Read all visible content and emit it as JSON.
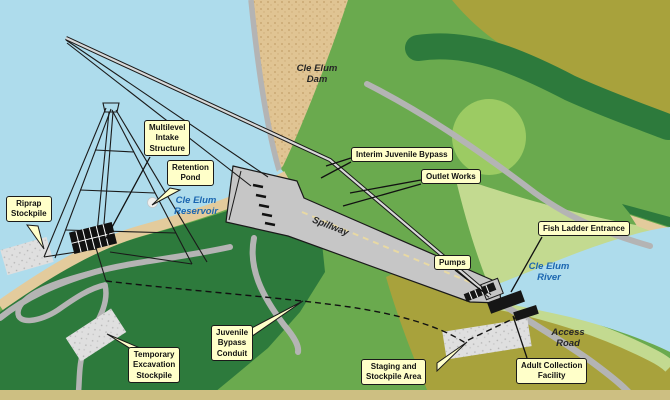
{
  "figure": {
    "type": "site-plan-map",
    "subject": "Cle Elum Dam fish passage facilities site plan",
    "callouts": {
      "riprap": "Riprap\nStockpile",
      "multilevel": "Multilevel\nIntake\nStructure",
      "retention": "Retention\nPond",
      "interim": "Interim Juvenile Bypass",
      "outlet": "Outlet Works",
      "pumps": "Pumps",
      "fish_ladder": "Fish Ladder Entrance",
      "conduit": "Juvenile\nBypass\nConduit",
      "temp_excavation": "Temporary\nExcavation\nStockpile",
      "staging": "Staging and\nStockpile Area",
      "adult": "Adult Collection\nFacility"
    },
    "places": {
      "dam": "Cle Elum\nDam",
      "reservoir": "Cle Elum\nReservoir",
      "river": "Cle Elum\nRiver",
      "spillway": "Spillway",
      "access_road": "Access\nRoad"
    },
    "colors": {
      "water": "#aedcec",
      "beach_tan": "#e3cb9c",
      "dam_fill": "#e0c493",
      "dark_green": "#2d7a3c",
      "medium_green": "#6aaa4e",
      "pale_green": "#c3da90",
      "light_green_blob": "#9ccb63",
      "olive": "#a8a23c",
      "road_gray": "#b4b4b4",
      "spillway_gray": "#c6c6c6",
      "spillway_centerline": "#e8d9a4",
      "stockpile_gray": "#dfdfdf",
      "callout_bg": "#ffffc9",
      "bottom_strip_tan": "#cdbf82",
      "place_label_blue": "#1b66b0",
      "line_black": "#1a1a1a"
    }
  }
}
